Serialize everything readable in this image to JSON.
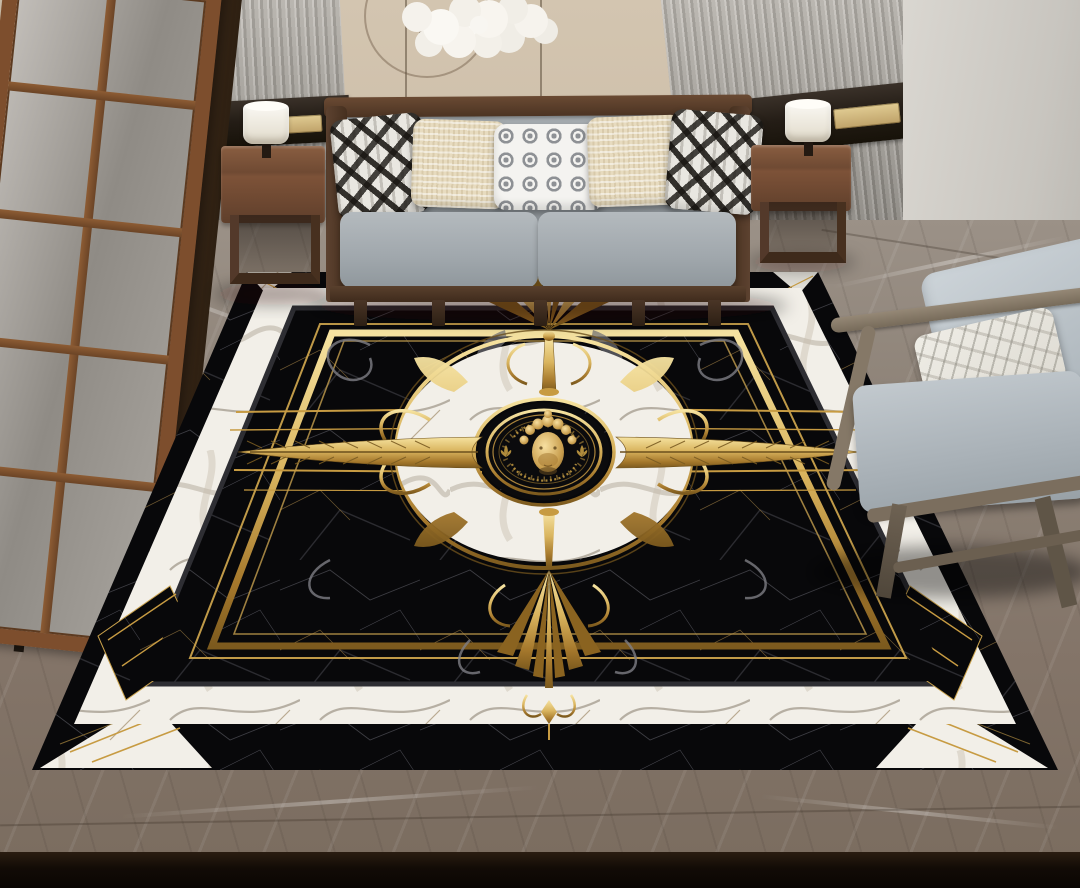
{
  "meta": {
    "title": "Living room with black-and-gold baroque medallion rug",
    "width_px": 1080,
    "height_px": 888,
    "visible_text": "none (rug medallion lettering is decorative and illegible)"
  },
  "palette": {
    "wall_beige": "#cfc0ab",
    "panel_gray": "#a8a49d",
    "band_dark": "#241d16",
    "accent_brass": "#bfa269",
    "wood_door": "#7d4e2d",
    "wood_sofa": "#4c3423",
    "wood_table": "#5f3f2b",
    "chair_wood": "#776b5a",
    "floor_marble": "#837468",
    "cushion_gray": "#a0a7ac",
    "pillow_cream": "#e7dbbf",
    "pillow_white": "#d9d6cd",
    "rug_black": "#08080a",
    "rug_gold": "#c79b42",
    "rug_gold_dark": "#8a6320",
    "rug_white": "#f2efe8",
    "bottom_strip": "#120b06"
  },
  "scene": {
    "wall": {
      "center": "beige plaster panel",
      "sides": "gray fluted wood panels",
      "accent": "dark walnut horizontal band with two brass switch plates",
      "right": "light gray textured panel"
    },
    "decor": {
      "chandelier": "white blossom cluster hanging from thin wires",
      "door": "wood-framed glass paneled door at left",
      "background_chair": "dark chair silhouette behind door"
    },
    "furniture": {
      "sofa": {
        "frame": "dark walnut wood",
        "upholstery": "light gray fabric",
        "seats": 2,
        "pillows": [
          {
            "pattern": "black-white ikat diamond"
          },
          {
            "pattern": "cream woven texture"
          },
          {
            "pattern": "white with gray circle grid"
          },
          {
            "pattern": "cream woven texture"
          },
          {
            "pattern": "black-white ikat diamond"
          }
        ]
      },
      "side_tables": {
        "count": 2,
        "material": "walnut, open base"
      },
      "lamps": {
        "count": 2,
        "shade": "white drum"
      },
      "armchair": {
        "position": "right",
        "frame": "gray-brown wood",
        "cushions": "light gray",
        "pillow": "white marble print"
      }
    },
    "floor": {
      "material": "gray-taupe marble tile with white veining"
    },
    "rug": {
      "style": "baroque medallion, perspective trapezoid",
      "field": "black marble with fine white and gold veins",
      "border": "white marble band with black chevron inserts and gold diagonal lines",
      "frames": "double gold rectangular frame lines inside black field",
      "medallion": {
        "ring": "white marble annulus edged in gold with gold scrollwork",
        "disc": "black center with concentric gold rings, tick dial, two illegible gold lettering arcs, two small gold fleur ornaments",
        "face": "gold classical head with curly hair at center"
      },
      "arms": [
        "gold feather arrow pointing left",
        "gold feather arrow pointing right",
        "gold palmette fan at top",
        "large gold acanthus pendant at bottom"
      ],
      "lines": "thin horizontal gold rays extending left and right of medallion"
    }
  }
}
